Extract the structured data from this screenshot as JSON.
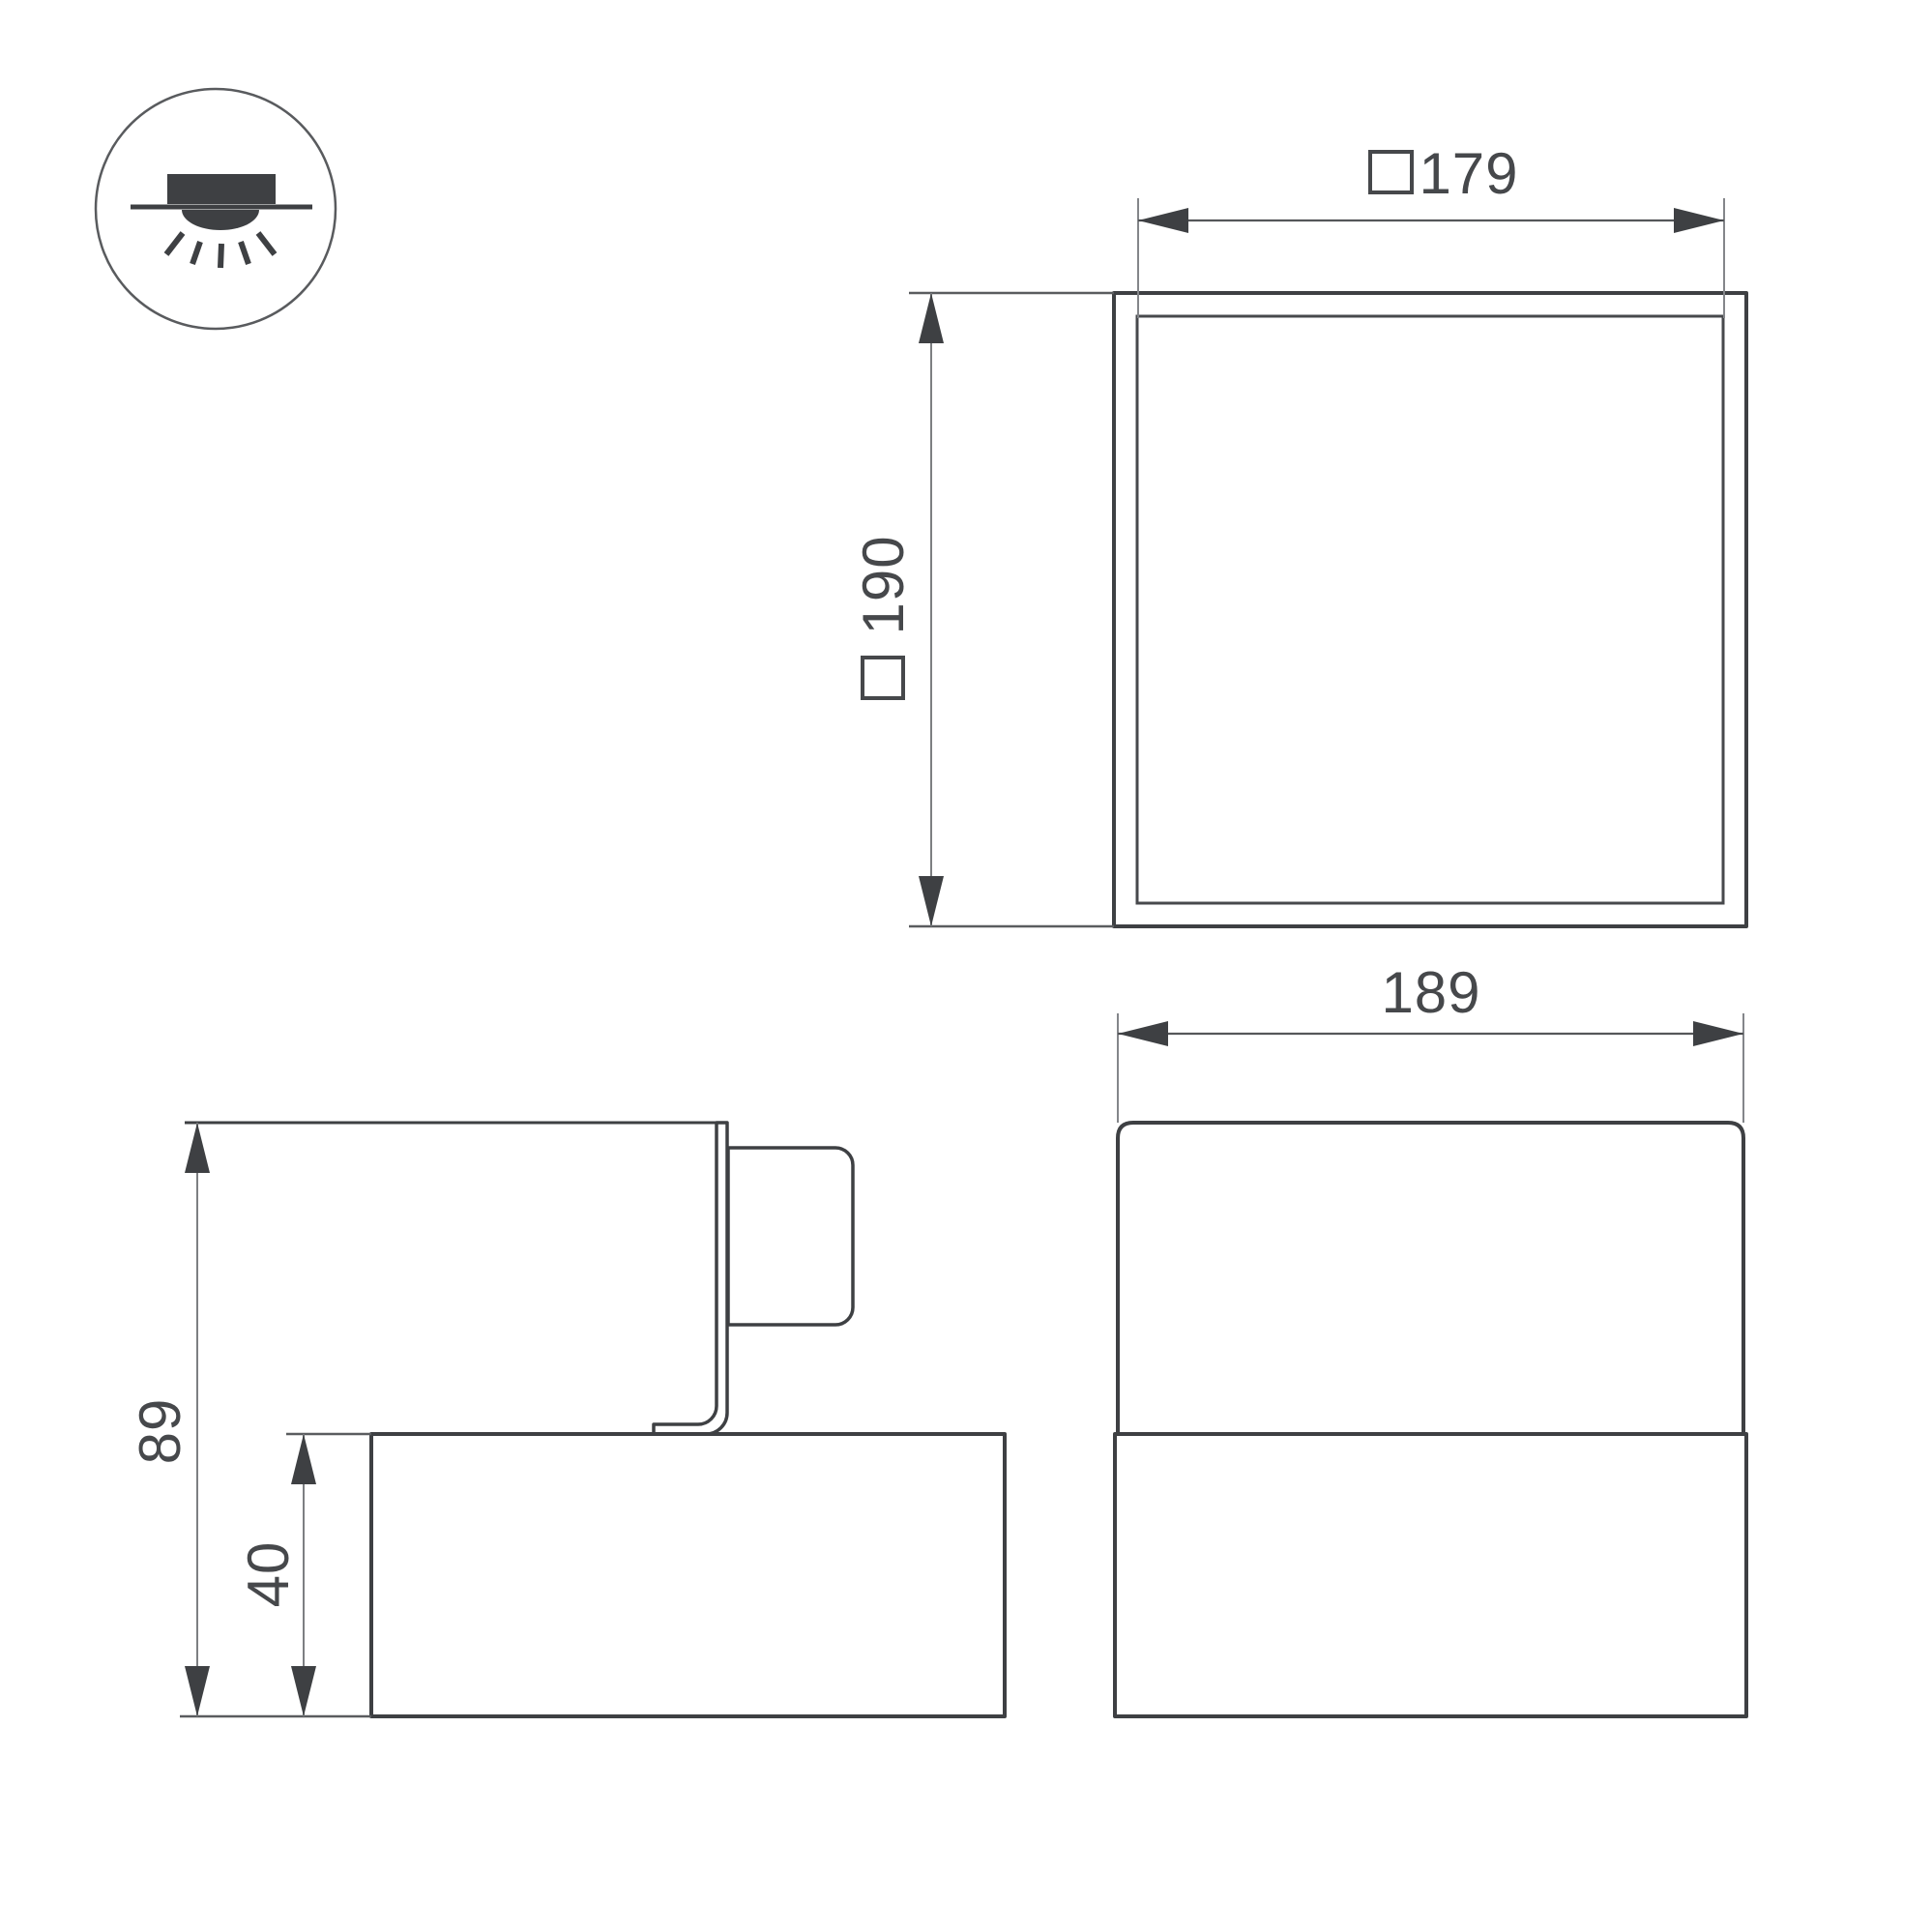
{
  "drawing": {
    "type": "luminaire-dimension-drawing",
    "icon": {
      "name": "recessed-ceiling-downlight-icon"
    },
    "dims": {
      "d179": "179",
      "d190": "190",
      "d189": "189",
      "d89": "89",
      "d40": "40",
      "square_prefix_symbol": "white-square-outline"
    },
    "views": {
      "top_view": {
        "width_label": "□179",
        "height_label": "□190"
      },
      "front_view": {
        "width_label": "189"
      },
      "side_view": {
        "total_height_label": "89",
        "body_height_label": "40"
      }
    },
    "colors": {
      "background": "#ffffff",
      "object_line": "#3e4043",
      "dimension_line": "#55575a",
      "extension_line": "#84868a",
      "text": "#46484b"
    }
  }
}
